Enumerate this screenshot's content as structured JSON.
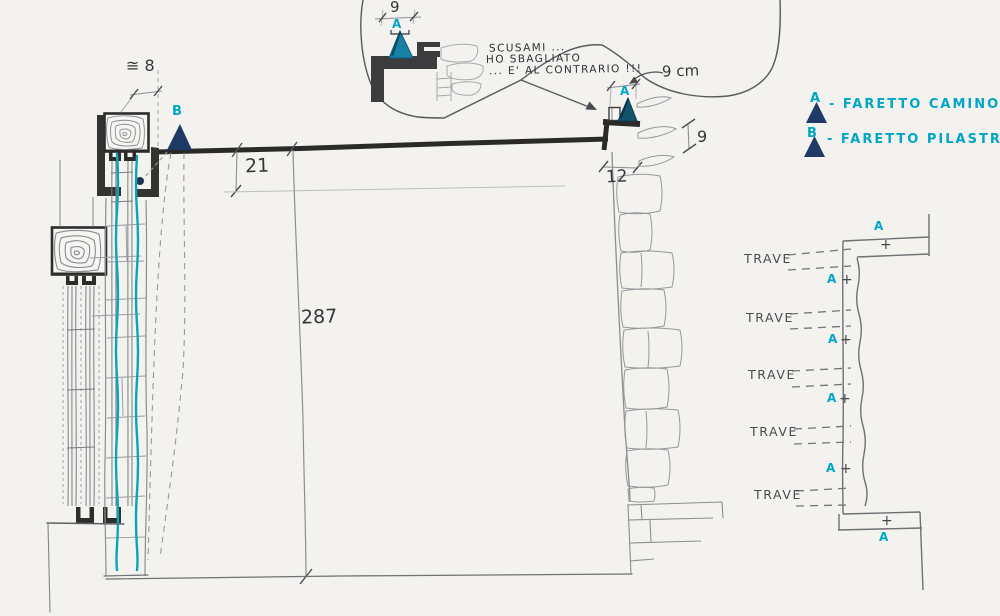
{
  "bubble": {
    "dim": "9",
    "marker": "A",
    "lines": [
      "SCUSAMI ...",
      "HO SBAGLIATO",
      "... E' AL CONTRARIO !!!"
    ]
  },
  "section": {
    "dim_track_width": "≅ 8",
    "marker_b": "B",
    "dim_beam_drop": "21",
    "dim_wall_height": "287",
    "dim_pillar_width": "12",
    "label_pillar_offset": "9 cm",
    "marker_a": "A",
    "dim_stone_height": "9"
  },
  "legend": {
    "items": [
      {
        "key": "A",
        "label": "- FARETTO CAMINO"
      },
      {
        "key": "B",
        "label": "- FARETTO PILASTRO"
      }
    ]
  },
  "plan": {
    "traves": [
      {
        "label": "TRAVE"
      },
      {
        "label": "TRAVE"
      },
      {
        "label": "TRAVE"
      },
      {
        "label": "TRAVE"
      },
      {
        "label": "TRAVE"
      }
    ],
    "markers": [
      {
        "key": "A",
        "plus": "+"
      },
      {
        "key": "A",
        "plus": "+"
      },
      {
        "key": "A",
        "plus": "+"
      },
      {
        "key": "A",
        "plus": "+"
      },
      {
        "key": "A",
        "plus": "+"
      },
      {
        "key": "A",
        "plus": "+"
      }
    ]
  },
  "colors": {
    "cyan": "#00a6c6",
    "navy": "#203a66",
    "teal": "#1581a4"
  }
}
